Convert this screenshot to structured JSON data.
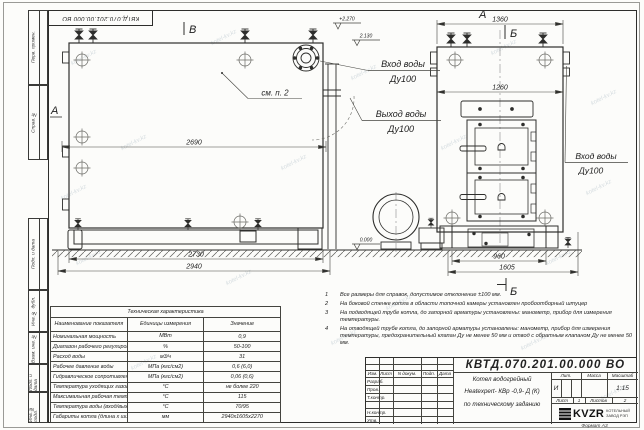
{
  "watermark": {
    "text": "kotel-kv.kz"
  },
  "frame": {
    "left_cells": [
      {
        "label": "Перв. примен."
      },
      {
        "label": "Справ. №"
      },
      {
        "label": "Подп. и дата"
      },
      {
        "label": "Инв. № дубл."
      },
      {
        "label": "Взам. инв. №"
      },
      {
        "label": "Подп. и дата"
      },
      {
        "label": "Инв. № подл."
      }
    ],
    "format_note": "Формат  А3"
  },
  "drawing": {
    "view_front": {
      "view_label": "В",
      "side_arrow_label": "А",
      "see_note": "см. п. 2",
      "dim_top": "2690",
      "dim_mid": "2730",
      "dim_overall": "2940"
    },
    "view_side": {
      "view_label": "А",
      "section_top": "Б",
      "section_bottom": "Б",
      "dim_top": "1360",
      "dim_inner": "1260",
      "dim_base": "960",
      "dim_overall": "1605"
    },
    "elevations": {
      "top": "+2.270",
      "inlet": "2.130",
      "zero": "0.000"
    },
    "ports": {
      "inlet_front": {
        "l1": "Вход воды",
        "l2": "Ду100"
      },
      "outlet": {
        "l1": "Выход воды",
        "l2": "Ду100"
      },
      "inlet_side": {
        "l1": "Вход воды",
        "l2": "Ду100"
      }
    }
  },
  "tech_table": {
    "title": "Техническая характеристика",
    "col_headers": [
      "Наименование показателя",
      "Единицы измерения",
      "Значение"
    ],
    "rows": [
      [
        "Номинальная мощность",
        "МВт",
        "0,9"
      ],
      [
        "Диапазон рабочего регулирования",
        "%",
        "50-100"
      ],
      [
        "Расход воды",
        "м3/ч",
        "31"
      ],
      [
        "Рабочее давление воды",
        "МПа (кгс/см2)",
        "0,6 (6,0)"
      ],
      [
        "Гидравлическое сопротивление котла",
        "МПа (кгс/см2)",
        "0,06 (0,6)"
      ],
      [
        "Температура уходящих газов",
        "°С",
        "не более 220"
      ],
      [
        "Максимальная рабочая температура воды",
        "°С",
        "115"
      ],
      [
        "Температура воды (вход/выход)",
        "°С",
        "70/95"
      ],
      [
        "Габариты котла (длина х ширина х высота)",
        "мм",
        "2940х1605х2270"
      ]
    ]
  },
  "notes": {
    "items": [
      {
        "num": "1",
        "text": "Все размеры для справок, допустимое отклонение ±100 мм."
      },
      {
        "num": "2",
        "text": "На боковой стенке котла в области топочной камеры установлен пробоотборный штуцер"
      },
      {
        "num": "3",
        "text": "На подводящей трубе котла, до запорной арматуры установлены: манометр, прибор для измерения температуры."
      },
      {
        "num": "4",
        "text": "На отводящей трубе котла, до запорной арматуры установлены: манометр, прибор для измерения температуры, предохранительный клапан Ду не менее 50 мм и отвод с обратным клапаном Ду не менее 50 мм."
      }
    ]
  },
  "title_block": {
    "doc_number": "КВТД.070.201.00.000  ВО",
    "product_line1": "Котел водогрейный",
    "product_line2": "Heatexpert- КВр -0,9- Д (К)",
    "product_line3": "по техническому заданию",
    "rev_headers": [
      "Изм.",
      "Лист",
      "N докум.",
      "Подп.",
      "Дата"
    ],
    "row_labels": [
      "Разраб.",
      "Пров.",
      "Т.контр.",
      "Н.контр.",
      "Утв."
    ],
    "lit_header": "Лит.",
    "mass_header": "Масса",
    "scale_header": "Масштаб",
    "lit_value": "И",
    "scale_value": "1:15",
    "sheet_label": "Лист",
    "sheet_value": "1",
    "sheets_label": "Листов",
    "sheets_value": "2",
    "logo_text": "KVZR",
    "company_line1": "КОТЕЛЬНЫЙ",
    "company_line2": "ЗАВОД РЭП"
  }
}
